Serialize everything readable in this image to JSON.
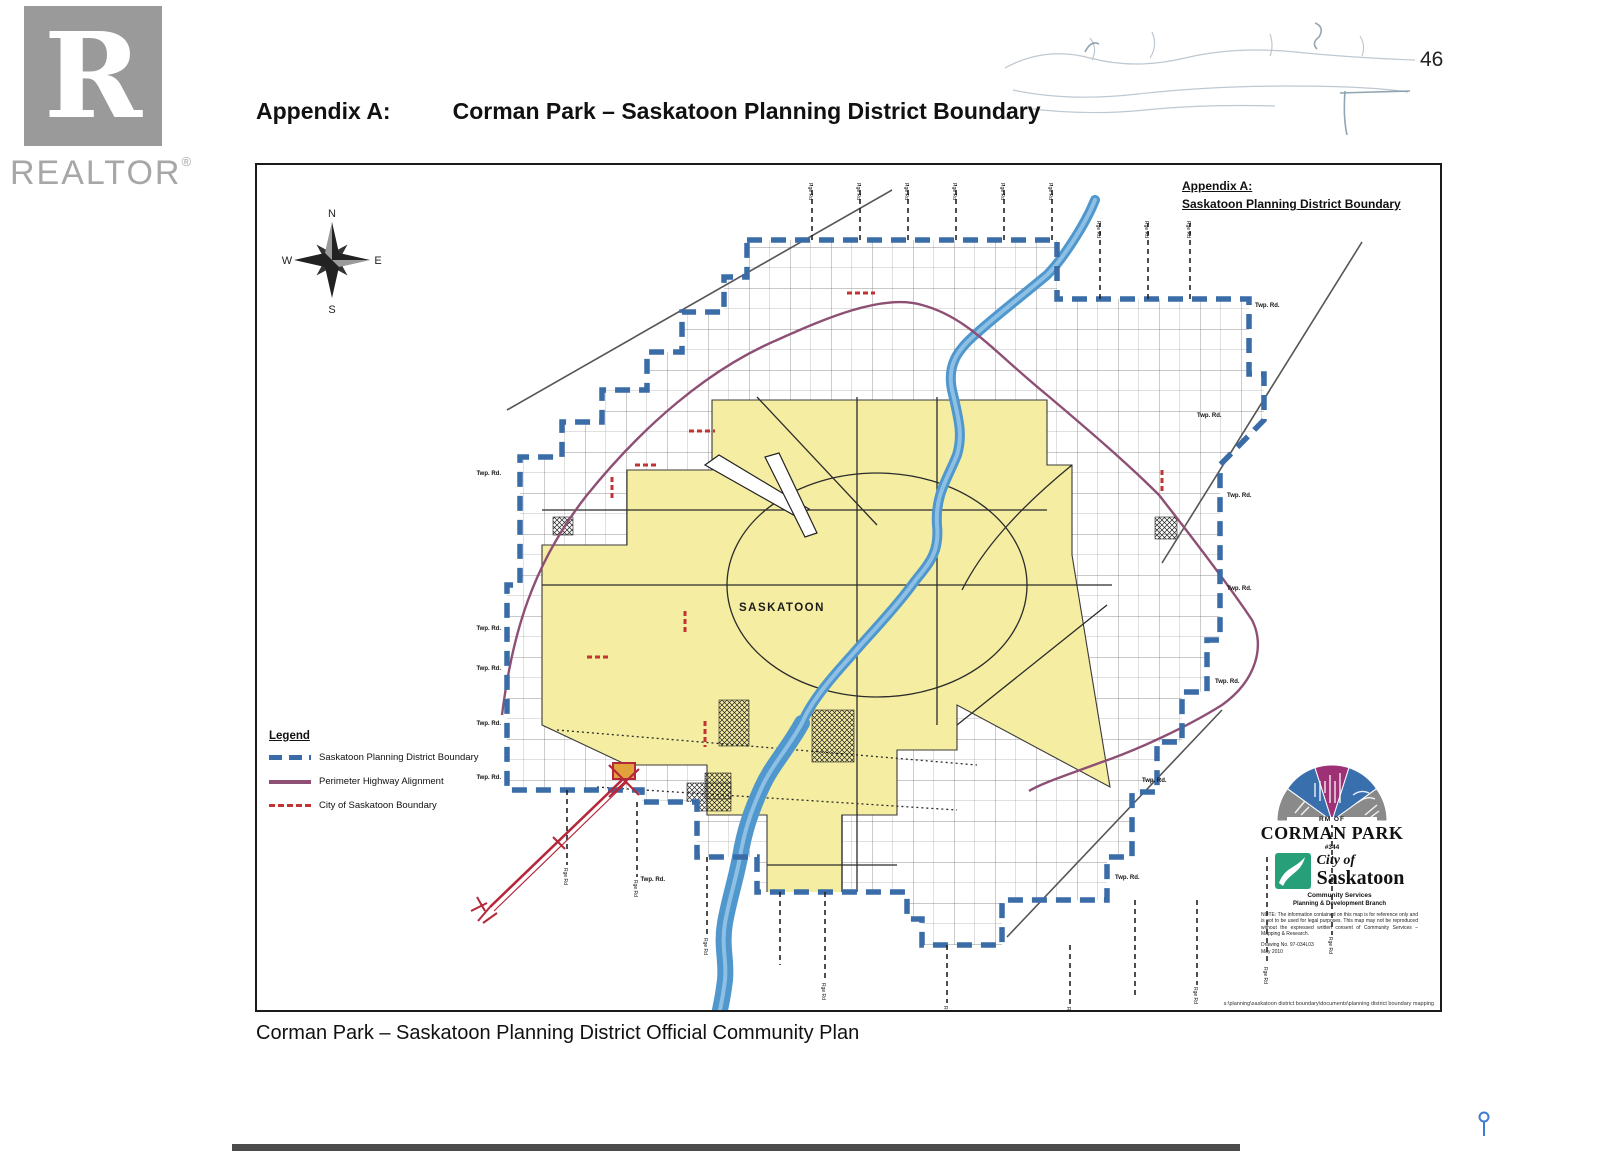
{
  "page": {
    "number": "46",
    "title_label": "Appendix A:",
    "title_text": "Corman Park – Saskatoon Planning District Boundary",
    "caption": "Corman Park – Saskatoon Planning District Official Community Plan"
  },
  "watermark": {
    "letter": "R",
    "brand": "REALTOR",
    "registered": "®"
  },
  "map": {
    "header_line1": "Appendix A:",
    "header_line2": "Saskatoon Planning District Boundary",
    "compass": {
      "n": "N",
      "e": "E",
      "s": "S",
      "w": "W"
    },
    "city_label": "SASKATOON",
    "twp_label": "Twp. Rd.",
    "rge_label": "Rge Rd",
    "legend": {
      "title": "Legend",
      "items": [
        {
          "label": "Saskatoon Planning District Boundary",
          "color": "#3a6ca8",
          "style": "blue-dashed"
        },
        {
          "label": "Perimeter Highway Alignment",
          "color": "#8e4f74",
          "style": "purple-solid"
        },
        {
          "label": "City of Saskatoon Boundary",
          "color": "#c23333",
          "style": "red-dashed"
        }
      ]
    },
    "colors": {
      "district_boundary": "#3a6ca8",
      "perimeter_highway": "#8e4f74",
      "city_boundary_red": "#c23333",
      "city_fill": "#f5eda2",
      "river": "#5b9ccc"
    },
    "logos": {
      "corman": {
        "rm_of": "RM OF",
        "name": "CORMAN PARK",
        "number": "#344"
      },
      "saskatoon": {
        "city_of": "City of",
        "name": "Saskatoon",
        "line1": "Community Services",
        "line2": "Planning & Development Branch",
        "note": "NOTE: The information contained on this map is for reference only and is not to be used for legal purposes. This map may not be reproduced without the expressed written consent of Community Services – Mapping & Research.",
        "ref1": "Drawing No. 97-034L03",
        "ref2": "May 2010"
      },
      "footer_path": "s:\\planning\\saskatoon district boundary\\documents\\planning district boundary mapping"
    }
  }
}
